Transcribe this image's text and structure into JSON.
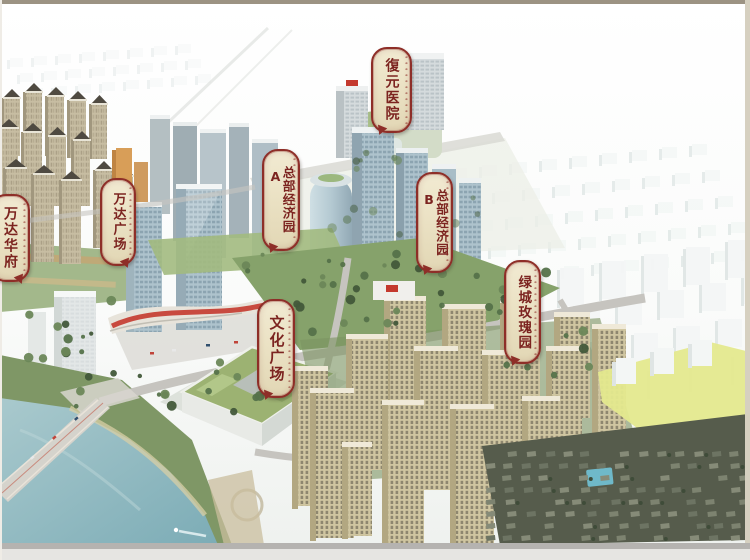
{
  "labels": [
    {
      "id": "fuyuan-hospital",
      "text": "復元医院",
      "suffix": ""
    },
    {
      "id": "wanda-huafu",
      "text": "万达华府",
      "suffix": ""
    },
    {
      "id": "wanda-plaza",
      "text": "万达广场",
      "suffix": ""
    },
    {
      "id": "hq-economic-park-a",
      "text": "总部经济园",
      "suffix": "A"
    },
    {
      "id": "hq-economic-park-b",
      "text": "总部经济园",
      "suffix": "B"
    },
    {
      "id": "culture-plaza",
      "text": "文化广场",
      "suffix": ""
    },
    {
      "id": "greentown-rose-garden",
      "text": "绿城玫瑰园",
      "suffix": ""
    }
  ],
  "colors": {
    "label_bg": "#ece3c6",
    "label_border": "#8e2e28",
    "label_text": "#7c2420",
    "water": "#8db7bf",
    "park_green": "#86a26b",
    "tree_green": "#55724a",
    "glass_blue": "#aec3cd",
    "residential_tan": "#d0c6a1",
    "residential_beige": "#c7bda2",
    "mall_red": "#c4392e",
    "road_gray": "#c6c4bf",
    "yellow_parcel": "#e4e98e",
    "white_massing": "#f3f6f5",
    "villa_dark": "#565c4c"
  }
}
